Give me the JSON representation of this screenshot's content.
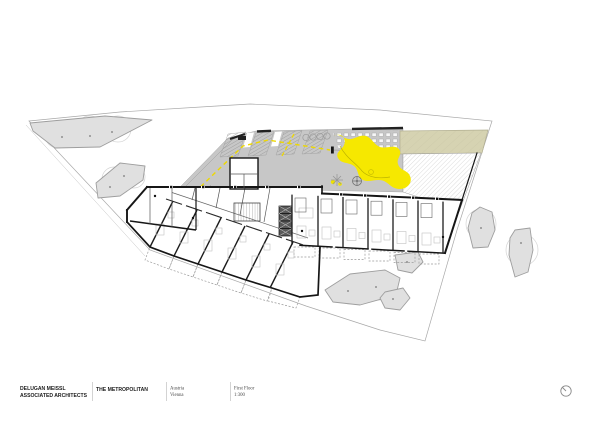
{
  "title_block": {
    "firm_line1": "DELUGAN MEISSL",
    "firm_line2": "ASSOCIATED ARCHITECTS",
    "project": "THE METROPOLITAN",
    "location_line1": "Austria",
    "location_line2": "Vienna",
    "sheet_name": "First Floor",
    "sheet_scale": "1:300"
  },
  "icons": {
    "north_arrow": "compass-circle-with-needle"
  },
  "colors": {
    "deck": "#c7c7c7",
    "vegetation": "#e0e0e0",
    "vegetation_outline": "#9e9e9e",
    "playground": "#f6e800",
    "planted_area": "#d6d3b2",
    "road_marking": "#eed800",
    "walls": "#161616",
    "boundary": "#a8a8a8"
  }
}
